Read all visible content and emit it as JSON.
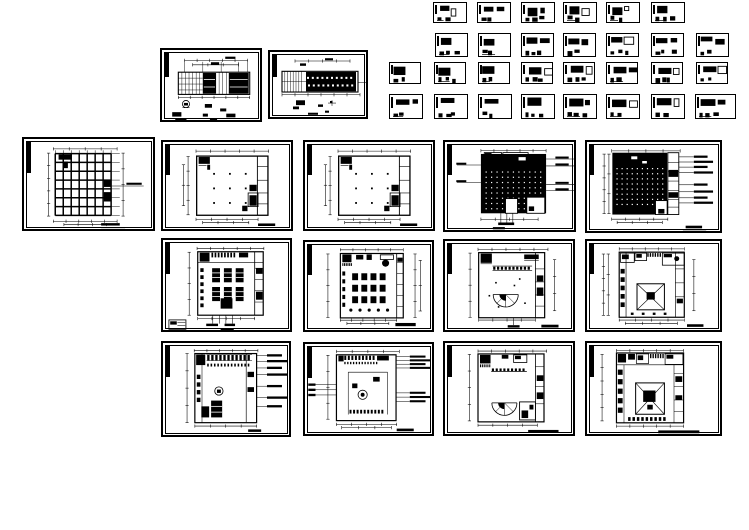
{
  "canvas": {
    "width": 749,
    "height": 530,
    "background": "#ffffff",
    "ink": "#000000"
  },
  "document": {
    "kind": "cad-drawing-set",
    "description": "interior CAD sheet set: plans, ceiling plans, elevations and detail sheets",
    "sheet_count": 44
  },
  "sheets": [
    {
      "id": "d01",
      "kind": "detail",
      "x": 433,
      "y": 2,
      "w": 34,
      "h": 21,
      "seed": 1
    },
    {
      "id": "d02",
      "kind": "detail",
      "x": 477,
      "y": 2,
      "w": 34,
      "h": 21,
      "seed": 2
    },
    {
      "id": "d03",
      "kind": "detail",
      "x": 521,
      "y": 2,
      "w": 34,
      "h": 21,
      "seed": 3
    },
    {
      "id": "d04",
      "kind": "detail",
      "x": 563,
      "y": 2,
      "w": 34,
      "h": 21,
      "seed": 4
    },
    {
      "id": "d05",
      "kind": "detail",
      "x": 606,
      "y": 2,
      "w": 34,
      "h": 21,
      "seed": 5
    },
    {
      "id": "d06",
      "kind": "detail",
      "x": 651,
      "y": 2,
      "w": 34,
      "h": 21,
      "seed": 6
    },
    {
      "id": "d07",
      "kind": "detail",
      "x": 435,
      "y": 33,
      "w": 33,
      "h": 24,
      "seed": 7
    },
    {
      "id": "d08",
      "kind": "detail",
      "x": 478,
      "y": 33,
      "w": 33,
      "h": 24,
      "seed": 8
    },
    {
      "id": "d09",
      "kind": "detail",
      "x": 521,
      "y": 33,
      "w": 33,
      "h": 24,
      "seed": 9
    },
    {
      "id": "d10",
      "kind": "detail",
      "x": 563,
      "y": 33,
      "w": 33,
      "h": 24,
      "seed": 10
    },
    {
      "id": "d11",
      "kind": "detail",
      "x": 606,
      "y": 33,
      "w": 33,
      "h": 24,
      "seed": 11
    },
    {
      "id": "d12",
      "kind": "detail",
      "x": 651,
      "y": 33,
      "w": 33,
      "h": 24,
      "seed": 12
    },
    {
      "id": "d13",
      "kind": "detail",
      "x": 696,
      "y": 33,
      "w": 33,
      "h": 24,
      "seed": 13
    },
    {
      "id": "d14",
      "kind": "detail",
      "x": 389,
      "y": 62,
      "w": 32,
      "h": 22,
      "seed": 14
    },
    {
      "id": "d15",
      "kind": "detail",
      "x": 434,
      "y": 62,
      "w": 32,
      "h": 22,
      "seed": 15
    },
    {
      "id": "d16",
      "kind": "detail",
      "x": 478,
      "y": 62,
      "w": 32,
      "h": 22,
      "seed": 16
    },
    {
      "id": "d17",
      "kind": "detail",
      "x": 521,
      "y": 62,
      "w": 32,
      "h": 22,
      "seed": 17
    },
    {
      "id": "d18",
      "kind": "detail",
      "x": 563,
      "y": 62,
      "w": 32,
      "h": 22,
      "seed": 18
    },
    {
      "id": "d19",
      "kind": "detail",
      "x": 606,
      "y": 62,
      "w": 32,
      "h": 22,
      "seed": 19
    },
    {
      "id": "d20",
      "kind": "detail",
      "x": 651,
      "y": 62,
      "w": 32,
      "h": 22,
      "seed": 20
    },
    {
      "id": "d21",
      "kind": "detail",
      "x": 696,
      "y": 62,
      "w": 32,
      "h": 22,
      "seed": 21
    },
    {
      "id": "d22",
      "kind": "detail",
      "x": 389,
      "y": 94,
      "w": 34,
      "h": 25,
      "seed": 22
    },
    {
      "id": "d23",
      "kind": "detail",
      "x": 434,
      "y": 94,
      "w": 34,
      "h": 25,
      "seed": 23
    },
    {
      "id": "d24",
      "kind": "detail",
      "x": 478,
      "y": 94,
      "w": 34,
      "h": 25,
      "seed": 24
    },
    {
      "id": "d25",
      "kind": "detail",
      "x": 521,
      "y": 94,
      "w": 34,
      "h": 25,
      "seed": 25
    },
    {
      "id": "d26",
      "kind": "detail",
      "x": 563,
      "y": 94,
      "w": 34,
      "h": 25,
      "seed": 26
    },
    {
      "id": "d27",
      "kind": "detail",
      "x": 606,
      "y": 94,
      "w": 34,
      "h": 25,
      "seed": 27
    },
    {
      "id": "d28",
      "kind": "detail",
      "x": 651,
      "y": 94,
      "w": 34,
      "h": 25,
      "seed": 28
    },
    {
      "id": "d29",
      "kind": "detail",
      "x": 695,
      "y": 94,
      "w": 41,
      "h": 25,
      "seed": 29
    },
    {
      "id": "ea",
      "kind": "elevation-a",
      "x": 160,
      "y": 48,
      "w": 102,
      "h": 74
    },
    {
      "id": "eb",
      "kind": "elevation-b",
      "x": 268,
      "y": 50,
      "w": 100,
      "h": 69
    },
    {
      "id": "p1",
      "kind": "grid-plan",
      "x": 22,
      "y": 137,
      "w": 133,
      "h": 94
    },
    {
      "id": "p2",
      "kind": "empty-plan",
      "x": 161,
      "y": 140,
      "w": 132,
      "h": 91
    },
    {
      "id": "p3",
      "kind": "empty-plan",
      "x": 303,
      "y": 140,
      "w": 132,
      "h": 91
    },
    {
      "id": "p4",
      "kind": "dark-plan",
      "x": 443,
      "y": 140,
      "w": 133,
      "h": 92
    },
    {
      "id": "p5",
      "kind": "dark-plan2",
      "x": 585,
      "y": 140,
      "w": 137,
      "h": 93
    },
    {
      "id": "q1",
      "kind": "furnished-plan",
      "x": 161,
      "y": 238,
      "w": 131,
      "h": 94
    },
    {
      "id": "q2",
      "kind": "banquet-plan",
      "x": 303,
      "y": 240,
      "w": 131,
      "h": 92
    },
    {
      "id": "q3",
      "kind": "arc-plan",
      "x": 443,
      "y": 239,
      "w": 132,
      "h": 93
    },
    {
      "id": "q4",
      "kind": "square-plan",
      "x": 585,
      "y": 239,
      "w": 137,
      "h": 93
    },
    {
      "id": "r1",
      "kind": "annot-plan",
      "x": 161,
      "y": 341,
      "w": 130,
      "h": 96
    },
    {
      "id": "r2",
      "kind": "annot-plan2",
      "x": 303,
      "y": 342,
      "w": 131,
      "h": 94
    },
    {
      "id": "r3",
      "kind": "arc-plan2",
      "x": 443,
      "y": 341,
      "w": 132,
      "h": 95
    },
    {
      "id": "r4",
      "kind": "court-plan",
      "x": 585,
      "y": 341,
      "w": 137,
      "h": 95
    }
  ]
}
